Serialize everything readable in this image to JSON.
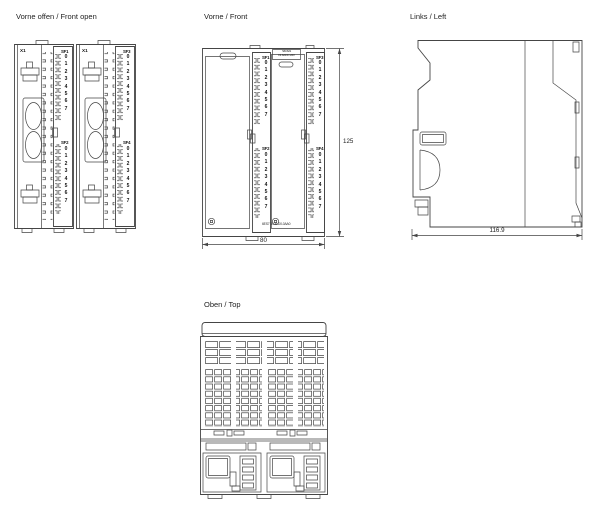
{
  "drawing": {
    "line_color": "#454545",
    "background": "#ffffff"
  },
  "views": {
    "front_open": {
      "title": "Vorne offen / Front open",
      "modules": [
        {
          "connector_label": "X1"
        },
        {
          "connector_label": "X1"
        }
      ]
    },
    "front": {
      "title": "Vorne / Front",
      "type_label": {
        "line1": "SM 321",
        "line2": "DI 32xDC 24V"
      },
      "order_number": "6ES7 14-4LD0-0AA0",
      "dimensions": {
        "width": "80",
        "height": "125"
      }
    },
    "left": {
      "title": "Links / Left",
      "dimensions": {
        "depth": "116.9"
      }
    },
    "top": {
      "title": "Oben / Top"
    }
  },
  "led_groups": [
    {
      "label": "SF1",
      "digits": "0\n1\n2\n3\n4\n5\n6\n7"
    },
    {
      "label": "SF2",
      "digits": "0\n1\n2\n3\n4\n5\n6\n7"
    },
    {
      "label": "SF3",
      "digits": "0\n1\n2\n3\n4\n5\n6\n7"
    },
    {
      "label": "SF4",
      "digits": "0\n1\n2\n3\n4\n5\n6\n7"
    }
  ]
}
